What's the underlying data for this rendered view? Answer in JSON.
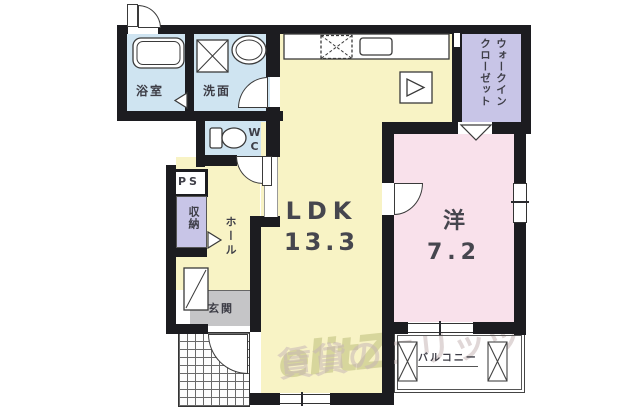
{
  "plan": {
    "rooms": {
      "bathroom": {
        "label": "浴室"
      },
      "washroom": {
        "label": "洗面"
      },
      "wc": {
        "label": "WC"
      },
      "walk_in_closet": {
        "label_line1": "ウォークイン",
        "label_line2": "クローゼット"
      },
      "pipe_space": {
        "label": "PS"
      },
      "storage": {
        "label": "収納"
      },
      "hall": {
        "label": "ホール"
      },
      "entrance": {
        "label": "玄関"
      },
      "ldk": {
        "label": "LDK",
        "size": "13.3"
      },
      "western_room": {
        "label": "洋",
        "size": "7.2"
      },
      "balcony": {
        "label": "バルコニー"
      }
    },
    "watermark": {
      "logo": "elitZ",
      "text": "賃貸のエリッツ"
    },
    "colors": {
      "wall": "#1c1c20",
      "cream": "#f8f3c5",
      "blue": "#cfe4f1",
      "pink": "#f9e1eb",
      "lav": "#c8c5e7",
      "gray": "#c5c5c7"
    }
  }
}
